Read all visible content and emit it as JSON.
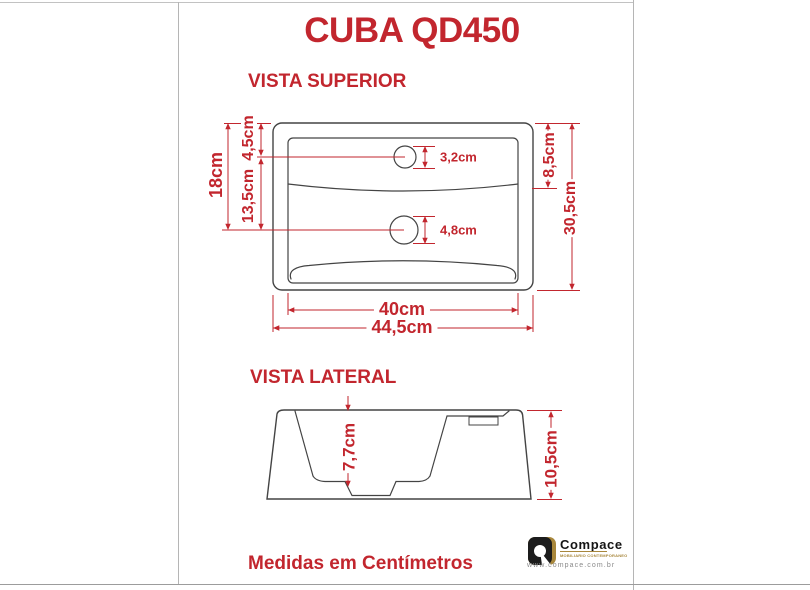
{
  "title": "CUBA QD450",
  "footer": "Medidas em Centímetros",
  "colors": {
    "accent_red": "#C2262E",
    "drawing_line": "#444444",
    "logo_gold": "#A8873C",
    "logo_gray": "#8A8A8A"
  },
  "top_view": {
    "heading": "VISTA SUPERIOR",
    "dims": {
      "total_height": "18cm",
      "upper_section": "4,5cm",
      "lower_section": "13,5cm",
      "faucet_hole": "3,2cm",
      "ledge_depth": "8,5cm",
      "total_depth": "30,5cm",
      "drain_hole": "4,8cm",
      "inner_width": "40cm",
      "outer_width": "44,5cm"
    }
  },
  "side_view": {
    "heading": "VISTA LATERAL",
    "dims": {
      "basin_depth": "7,7cm",
      "total_height": "10,5cm"
    }
  },
  "logo": {
    "brand": "Compace",
    "tagline": "MOBILIARIO CONTEMPORANEO",
    "website": "www.compace.com.br"
  }
}
